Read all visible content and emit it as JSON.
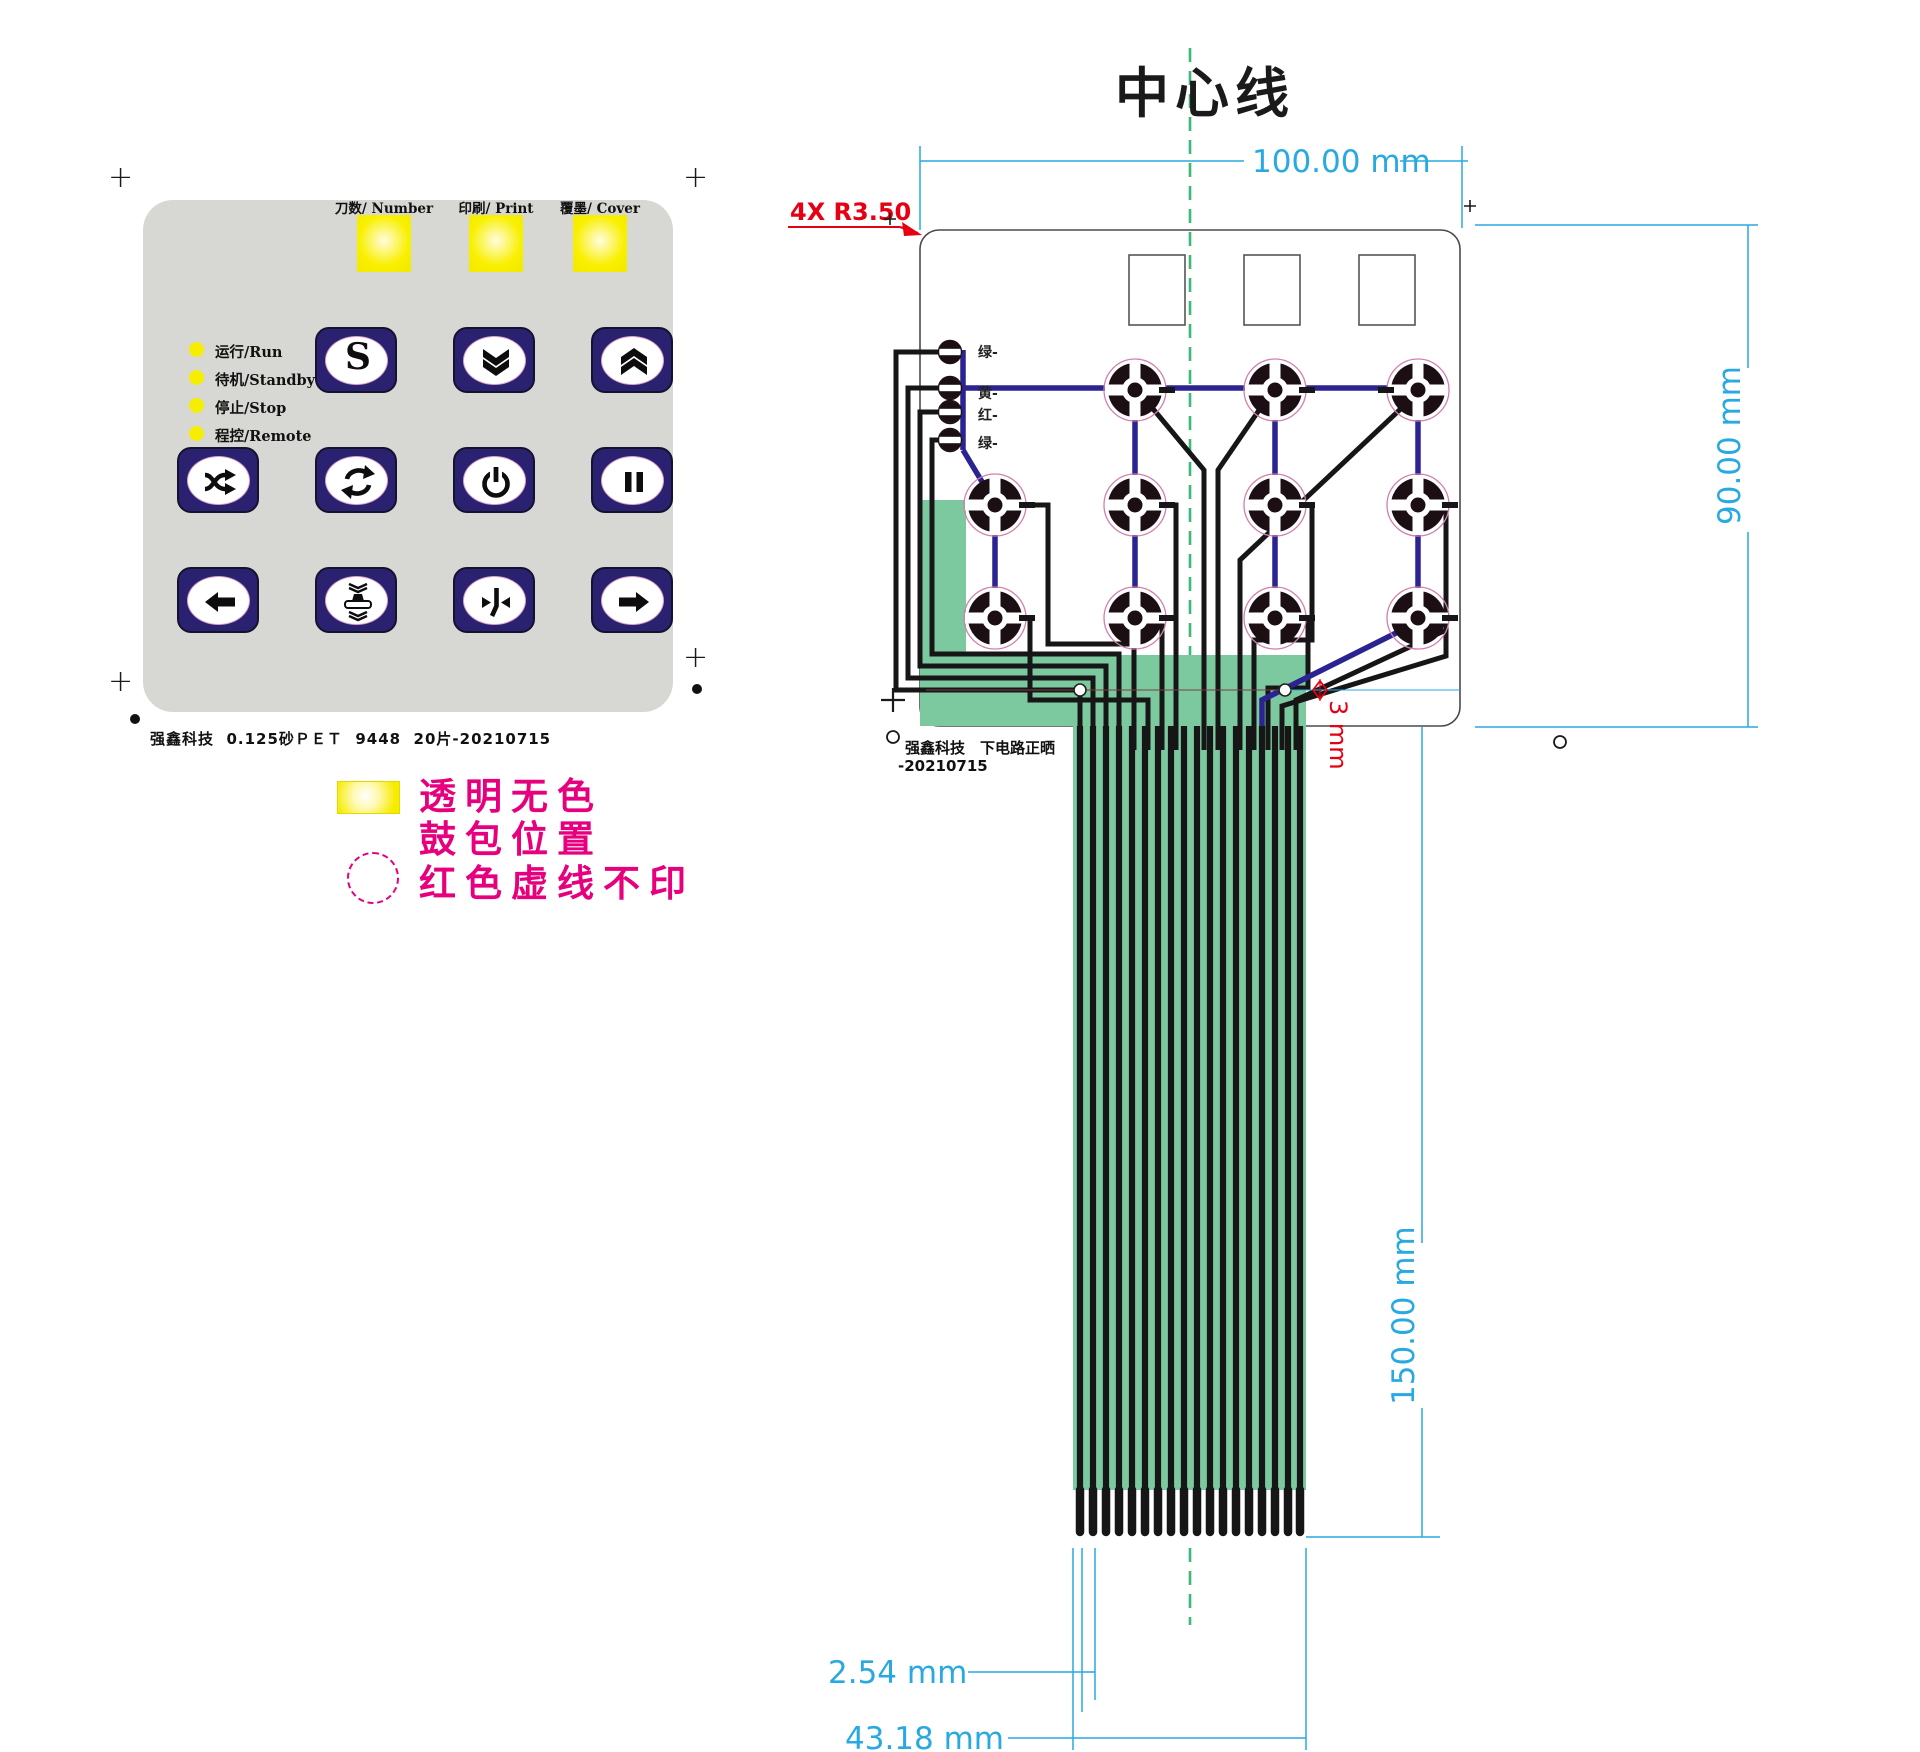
{
  "title": "中心线",
  "keypad": {
    "windows": [
      {
        "label": "刀数/ Number"
      },
      {
        "label": "印刷/ Print"
      },
      {
        "label": "覆墨/ Cover"
      }
    ],
    "leds": [
      {
        "label": "运行/Run"
      },
      {
        "label": "待机/Standby"
      },
      {
        "label": "停止/Stop"
      },
      {
        "label": "程控/Remote"
      }
    ],
    "s_button_letter": "S",
    "buttons": [
      {
        "name": "speed-s",
        "icon": "s-letter-icon"
      },
      {
        "name": "double-chevron-down",
        "icon": "double-chevron-down-icon"
      },
      {
        "name": "double-chevron-up",
        "icon": "double-chevron-up-icon"
      },
      {
        "name": "shuffle",
        "icon": "shuffle-icon"
      },
      {
        "name": "cycle",
        "icon": "rotate-icon"
      },
      {
        "name": "power",
        "icon": "power-icon"
      },
      {
        "name": "pause",
        "icon": "pause-icon"
      },
      {
        "name": "arrow-left",
        "icon": "arrow-left-icon"
      },
      {
        "name": "press",
        "icon": "press-icon"
      },
      {
        "name": "merge",
        "icon": "merge-arrows-icon"
      },
      {
        "name": "arrow-right",
        "icon": "arrow-right-icon"
      }
    ],
    "footer": "强鑫科技  0.125砂ＰＥＴ  9448  20片-20210715"
  },
  "legend": {
    "line1": "透明无色",
    "line2": "鼓包位置",
    "line3": "红色虚线不印"
  },
  "circuit": {
    "corner_note": "4X R3.50",
    "led_contacts": [
      "绿-",
      "黄-",
      "红-",
      "绿-"
    ],
    "footer_line1": "强鑫科技　下电路正晒",
    "footer_line2": "-20210715",
    "pin_count": 18
  },
  "dimensions": {
    "width": "100.00 mm",
    "height": "90.00 mm",
    "tail_length": "150.00 mm",
    "pin_pitch": "2.54 mm",
    "tail_width": "43.18 mm",
    "hole": "3 mm"
  },
  "colors": {
    "dimension_cyan": "#29a9e1",
    "note_red": "#e60012",
    "legend_magenta": "#e6007e",
    "tail_green": "#7cc9a0",
    "centerline_green": "#3cb878",
    "trace_blue": "#2b2391",
    "button_navy": "#2b2171",
    "panel_gray": "#d7d7d4",
    "window_yellow": "#f6ee00"
  }
}
